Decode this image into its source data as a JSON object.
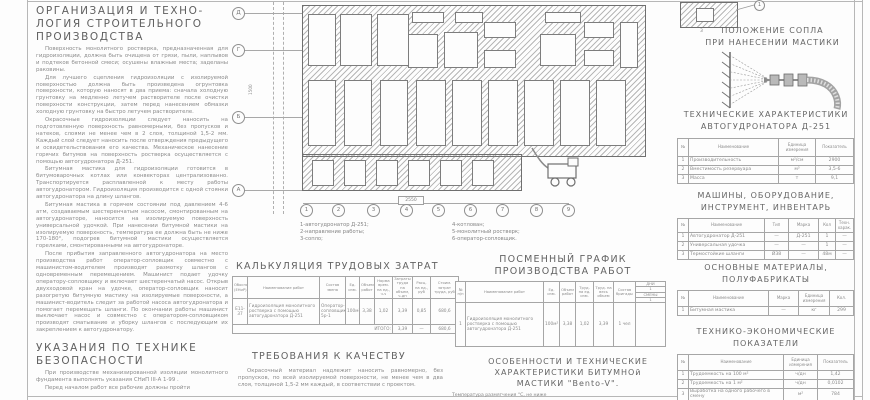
{
  "org": {
    "title_lines": [
      "ОРГАНИЗАЦИЯ  И  ТЕХНО-",
      "ЛОГИЯ  СТРОИТЕЛЬНОГО",
      "ПРОИЗВОДСТВА"
    ],
    "paragraphs": [
      "Поверхность монолитного ростверка, предназначенная для гидроизоляции, должна быть очищена от грязи, пыли, наплывов и подтеков бетонной смеси; осушены влажные места; заделаны раковины.",
      "Для лучшего сцепления гидроизоляции с изолируемой поверхностью должна быть произведена огрунтовка поверхности, которую наносят в два приема: сначала холодную грунтовку на медленно летучем растворителе после очистки поверхности конструкции, затем перед нанесением обмазки холодную грунтовку на быстро летучем растворителе.",
      "Окрасочные гидроизоляции следует наносить на подготовленную поверхность равномерными, без пропусков и натеков, слоями не менее чем в 2 слоя, толщиной 1,5-2 мм. Каждый слой следует наносить после отверждения предыдущего и освидетельствования его качества. Механическое нанесение горячих битумов на поверхность ростверка осуществляется с помощью автогудронатора Д-251.",
      "Битумная мастика для гидроизоляции готовится в битумоварочных котлах или конвекторах централизованно. Транспортируется расплавленной к месту работы автогудронатором. Гидроизоляция производится с одной стоянки автогудронатора на длину шлангов.",
      "Битумная мастика в горячем состоянии под давлением 4-6 атм, создаваемым шестеренчатым насосом, смонтированным на автогудронаторе, наносится на изолируемую поверхность универсальной удочкой. При нанесении битумной мастики на изолируемую поверхность, температура ее должна быть не ниже 170-180°, подогрев битумной мастики осуществляется горелками, смонтированными на автогудронаторе.",
      "После прибытия заправленного автогудронатора на место производства работ оператор-сопловщик совместно с машинистом-водителем производят размотку шлангов с одновременным перемещением. Машинист подает удочку оператору-сопловщику и включает шестеренчатый насос. Открыв двухходовой кран на удочке, оператор-сопловщик наносит разогретую битумную мастику на изолируемые поверхности, а машинист-водитель следит за работой насоса автогудронатора и помогает перемещать шланги. По окончании работы машинист выключает насос и совместно с оператором-сопловщиком производят сматывание и уборку шлангов с последующим их закреплением к автогудронатору."
    ]
  },
  "safety": {
    "title_lines": [
      "УКАЗАНИЯ  ПО  ТЕХНИКЕ",
      "БЕЗОПАСНОСТИ"
    ],
    "paragraphs": [
      "При производстве механизированной изоляции монолитного фундамента выполнять указания СНиП III-А 1-99 .",
      "Перед началом работ все рабочие должны пройти"
    ]
  },
  "plan": {
    "axis_letters": [
      "Д",
      "Г",
      "Б",
      "А"
    ],
    "axis_numbers": [
      "1",
      "2",
      "3",
      "4",
      "5",
      "6",
      "7",
      "8",
      "9"
    ],
    "dim_label": "2550",
    "vertical_dim": "1500",
    "legend_left": [
      "1-автогудронатор  Д-251;",
      "2-направление  работы;",
      "3-сопло;"
    ],
    "legend_right": [
      "4-котлован;",
      "5-монолитный  ростверк;",
      "6-оператор-сопловщик."
    ]
  },
  "calc": {
    "title": "КАЛЬКУЛЯЦИЯ  ТРУДОВЫХ  ЗАТРАТ",
    "headers": [
      "Обоснование (ЕНиР)",
      "Наименование работ",
      "Состав звена",
      "Ед. изм.",
      "Объем работ",
      "Норма врем. на ед., ч-ч",
      "Затраты труда на объем, ч-дн",
      "Расц. на ед., руб",
      "Стоим. затрат труда, руб"
    ],
    "row": [
      "Е11-37",
      "Гидроизоляция монолитного ростверка с помощью автогудронатора Д-251",
      "Оператор-сопловщик 5р-1",
      "100м²",
      "3,38",
      "1,02",
      "3,39",
      "0,85",
      "680,6"
    ],
    "total_label": "ИТОГО:",
    "totals": [
      "3,39",
      "—",
      "680,6"
    ]
  },
  "schedule": {
    "title_lines": [
      "ПОСМЕННЫЙ  ГРАФИК",
      "ПРОИЗВОДСТВА  РАБОТ"
    ],
    "headers": [
      "№ п/п",
      "Наименование работ",
      "Ед. изм.",
      "Объем работ",
      "Труд. на ед. изм.",
      "Труд. на весь объем",
      "Состав бригады"
    ],
    "days": {
      "label": "ДНИ",
      "day": "1",
      "shifts_label": "СМЕНЫ",
      "shift": "1"
    },
    "row": [
      "1",
      "Гидроизоляция монолитного ростверка с помощью автогудронатора Д-251",
      "100м²",
      "3,38",
      "1,02",
      "3,39",
      "1 чел"
    ]
  },
  "quality": {
    "title": "ТРЕБОВАНИЯ  К  КАЧЕСТВУ",
    "text": "Окрасочный материал надлежит наносить равномерно, без пропусков, по всей изолируемой поверхности, не менее чем в два слоя, толщиной 1,5-2 мм каждый, в соответствии с проектом."
  },
  "mastic": {
    "title_lines": [
      "ОСОБЕННОСТИ  И  ТЕХНИЧЕСКИЕ",
      "ХАРАКТЕРИСТИКИ  БИТУМНОй",
      "МАСТИКИ  \"Вento-V\"."
    ],
    "first_line": "Температура размягчения °С, не ниже"
  },
  "nozzle": {
    "title_lines": [
      "ПОЛОЖЕНИЕ  СОПЛА",
      "ПРИ  НАНЕСЕНИИ  МАСТИКИ"
    ]
  },
  "detail": {
    "labels": [
      "1",
      "3"
    ]
  },
  "tech_char": {
    "title_lines": [
      "ТЕХНИЧЕСКИЕ  ХАРАКТЕРИСТИКИ",
      "АВТОГУДРОНАТОРА  Д-251"
    ],
    "headers": [
      "№",
      "Наименование",
      "Единица измерения",
      "Показатель"
    ],
    "rows": [
      [
        "1",
        "Производительность",
        "м²/см",
        "2900"
      ],
      [
        "2",
        "Вместимость резервуара",
        "м³",
        "3,5-6"
      ],
      [
        "3",
        "Масса",
        "т",
        "9,1"
      ]
    ]
  },
  "machines": {
    "title_lines": [
      "МАШИНЫ,  ОБОРУДОВАНИЕ,",
      "ИНСТРУМЕНТ,  ИНВЕНТАРЬ"
    ],
    "headers": [
      "№",
      "Наименование",
      "Тип",
      "Марка",
      "Кол",
      "Техн. харак."
    ],
    "rows": [
      [
        "1",
        "Автогудронатор Д-251",
        "—",
        "Д-251",
        "1",
        "—"
      ],
      [
        "2",
        "Универсальная удочка",
        "—",
        "—",
        "1",
        "—"
      ],
      [
        "3",
        "Термостойкие шланги",
        "Ø38",
        "—",
        "48м",
        "—"
      ]
    ]
  },
  "materials": {
    "title_lines": [
      "ОСНОВНЫЕ  МАТЕРИАЛЫ,",
      "ПОЛУФАБРИКАТЫ"
    ],
    "headers": [
      "№",
      "Наименование",
      "Марка",
      "Единица измерения",
      "Кол."
    ],
    "rows": [
      [
        "1",
        "Битумная мастика",
        "—",
        "кг",
        "299"
      ]
    ]
  },
  "tech_econ": {
    "title_lines": [
      "ТЕХНИКО-ЭКОНОМИЧЕСКИЕ",
      "ПОКАЗАТЕЛИ"
    ],
    "headers": [
      "№",
      "Наименование",
      "Единица измерения",
      "Показатель"
    ],
    "rows": [
      [
        "1",
        "Трудоемкость на 100 м²",
        "ч/дн",
        "1,42"
      ],
      [
        "2",
        "Трудоемкость на 1 м²",
        "ч/дн",
        "0,0102"
      ],
      [
        "3",
        "Выработка на одного рабочего в смену",
        "м²",
        "784"
      ],
      [
        "4",
        "Потребность в механизмах",
        "маш/см",
        "0,06"
      ]
    ]
  }
}
